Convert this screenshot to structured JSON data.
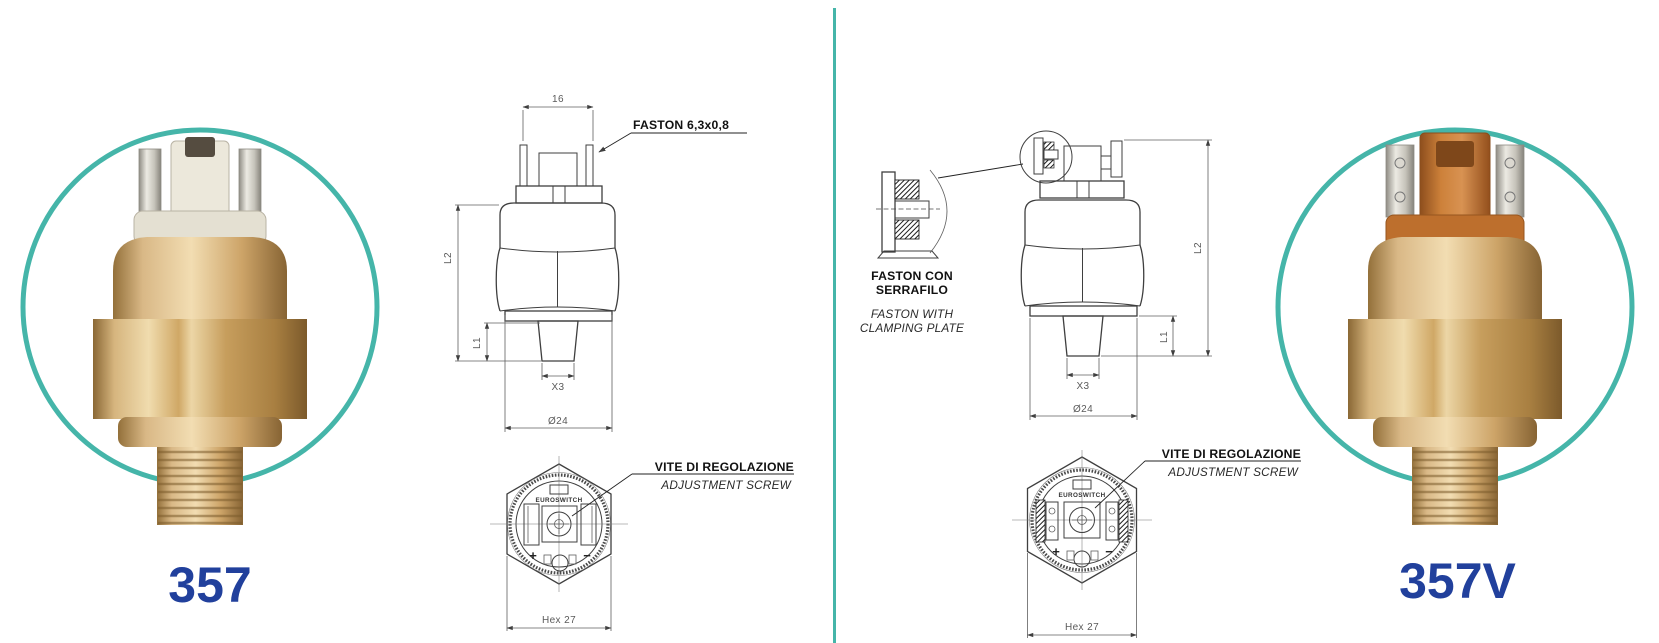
{
  "page": {
    "background_color": "#ffffff",
    "divider_color": "#45b5a9",
    "ring_color": "#45b5a9",
    "model_text_color": "#21409c",
    "brass_color": "#d2ab6e",
    "connector_color_left": "#ece8db",
    "connector_color_right": "#c1752f"
  },
  "products": {
    "left": {
      "model": "357"
    },
    "right": {
      "model": "357V"
    }
  },
  "left_drawing": {
    "dim_16": "16",
    "faston_label": "FASTON 6,3x0,8",
    "l2": "L2",
    "l1": "L1",
    "x3": "X3",
    "dia24": "Ø24",
    "brand": "EUROSWITCH",
    "plus": "+",
    "minus": "−",
    "hex27": "Hex 27",
    "adjust_it": "VITE DI REGOLAZIONE",
    "adjust_en": "ADJUSTMENT SCREW"
  },
  "right_drawing": {
    "detail_it1": "FASTON CON",
    "detail_it2": "SERRAFILO",
    "detail_en1": "FASTON WITH",
    "detail_en2": "CLAMPING PLATE",
    "l2": "L2",
    "l1": "L1",
    "x3": "X3",
    "dia24": "Ø24",
    "brand": "EUROSWITCH",
    "plus": "+",
    "minus": "−",
    "hex27": "Hex 27",
    "adjust_it": "VITE DI REGOLAZIONE",
    "adjust_en": "ADJUSTMENT SCREW"
  }
}
